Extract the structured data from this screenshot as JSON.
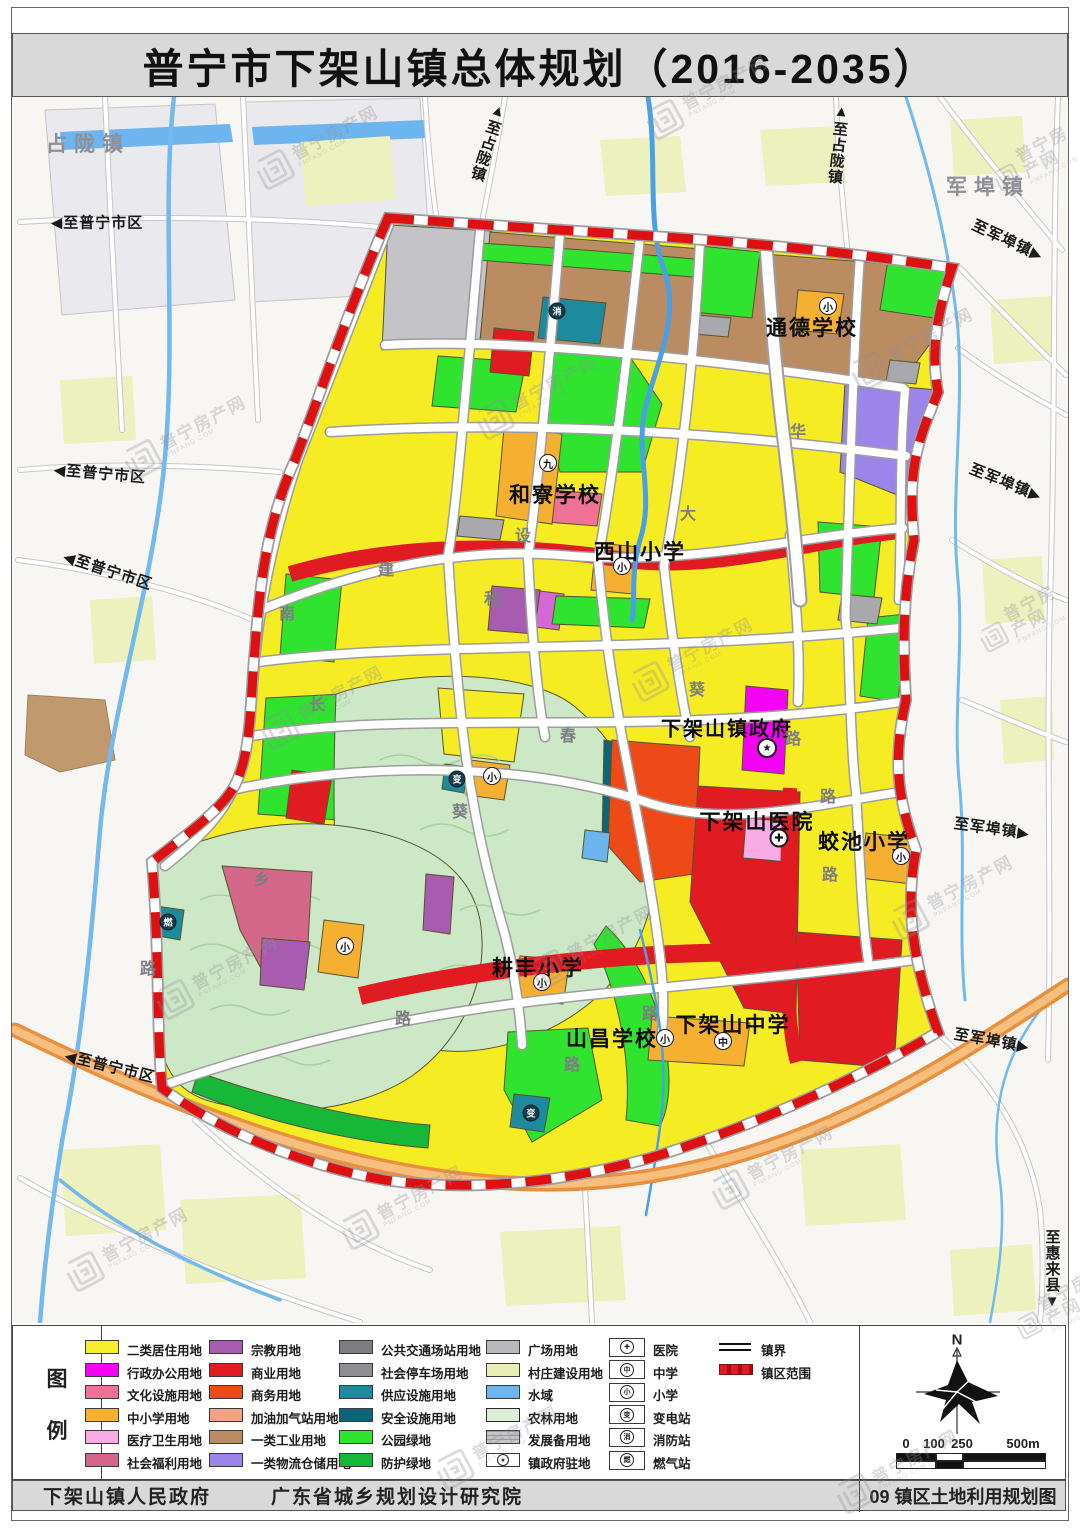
{
  "title": "普宁市下架山镇总体规划（2016-2035）",
  "watermark": {
    "name": "普宁房产网",
    "domain": "PNFANG.COM"
  },
  "compass_label": "N",
  "scalebar": {
    "labels": [
      "0",
      "100",
      "250",
      "500m"
    ]
  },
  "footer": {
    "credit1": "下架山镇人民政府",
    "credit2": "广东省城乡规划设计研究院",
    "sheet_no": "09 镇区土地利用规划图"
  },
  "map": {
    "area_labels": [
      {
        "t": "占陇镇",
        "x": 88,
        "y": 143
      },
      {
        "t": "军埠镇",
        "x": 988,
        "y": 186
      }
    ],
    "edge_labels": [
      {
        "t": "至普宁市区",
        "x": 97,
        "y": 222,
        "a": "l"
      },
      {
        "t": "至普宁市区",
        "x": 100,
        "y": 473,
        "a": "l",
        "r": 5
      },
      {
        "t": "至普宁市区",
        "x": 108,
        "y": 570,
        "a": "l",
        "r": 18
      },
      {
        "t": "至普宁市区",
        "x": 110,
        "y": 1066,
        "a": "l",
        "r": 14
      },
      {
        "t": "至占陇镇",
        "x": 488,
        "y": 142,
        "a": "u",
        "v": 1,
        "r": 18
      },
      {
        "t": "至占陇镇",
        "x": 838,
        "y": 144,
        "a": "u",
        "v": 1,
        "r": 6
      },
      {
        "t": "至军埠镇",
        "x": 1008,
        "y": 240,
        "a": "r",
        "r": 25
      },
      {
        "t": "至军埠镇",
        "x": 1006,
        "y": 482,
        "a": "r",
        "r": 22
      },
      {
        "t": "至军埠镇",
        "x": 992,
        "y": 828,
        "a": "r",
        "r": 8
      },
      {
        "t": "至军埠镇",
        "x": 992,
        "y": 1040,
        "a": "r",
        "r": 10
      },
      {
        "t": "至惠来县",
        "x": 1052,
        "y": 1270,
        "a": "d",
        "v": 1
      }
    ],
    "place_labels": [
      {
        "t": "通德学校",
        "x": 812,
        "y": 327
      },
      {
        "t": "和寮学校",
        "x": 555,
        "y": 494
      },
      {
        "t": "西山小学",
        "x": 640,
        "y": 551
      },
      {
        "t": "下架山镇政府",
        "x": 727,
        "y": 727,
        "s": 20
      },
      {
        "t": "下架山医院",
        "x": 757,
        "y": 821
      },
      {
        "t": "蛟池小学",
        "x": 864,
        "y": 841
      },
      {
        "t": "耕丰小学",
        "x": 538,
        "y": 967
      },
      {
        "t": "山昌学校",
        "x": 612,
        "y": 1038
      },
      {
        "t": "下架山中学",
        "x": 733,
        "y": 1024
      }
    ],
    "road_labels": [
      {
        "t": "建",
        "x": 386,
        "y": 568
      },
      {
        "t": "设",
        "x": 523,
        "y": 534
      },
      {
        "t": "和",
        "x": 492,
        "y": 597
      },
      {
        "t": "大",
        "x": 688,
        "y": 512
      },
      {
        "t": "南",
        "x": 287,
        "y": 612
      },
      {
        "t": "长",
        "x": 317,
        "y": 703
      },
      {
        "t": "春",
        "x": 568,
        "y": 734
      },
      {
        "t": "葵",
        "x": 697,
        "y": 688
      },
      {
        "t": "葵",
        "x": 460,
        "y": 810
      },
      {
        "t": "乡",
        "x": 262,
        "y": 878
      },
      {
        "t": "华",
        "x": 798,
        "y": 430
      },
      {
        "t": "路",
        "x": 793,
        "y": 737
      },
      {
        "t": "路",
        "x": 828,
        "y": 795
      },
      {
        "t": "路",
        "x": 830,
        "y": 873
      },
      {
        "t": "路",
        "x": 650,
        "y": 1012
      },
      {
        "t": "路",
        "x": 572,
        "y": 1063
      },
      {
        "t": "路",
        "x": 148,
        "y": 967
      },
      {
        "t": "路",
        "x": 403,
        "y": 1017
      }
    ],
    "point_icons": [
      {
        "g": "小",
        "x": 828,
        "y": 306,
        "k": "s"
      },
      {
        "g": "小",
        "x": 622,
        "y": 566,
        "k": "s"
      },
      {
        "g": "九",
        "x": 548,
        "y": 463,
        "k": "s"
      },
      {
        "g": "小",
        "x": 492,
        "y": 776,
        "k": "s"
      },
      {
        "g": "小",
        "x": 345,
        "y": 946,
        "k": "s"
      },
      {
        "g": "小",
        "x": 542,
        "y": 982,
        "k": "s"
      },
      {
        "g": "小",
        "x": 665,
        "y": 1038,
        "k": "s"
      },
      {
        "g": "小",
        "x": 901,
        "y": 856,
        "k": "s"
      },
      {
        "g": "中",
        "x": 723,
        "y": 1041,
        "k": "s"
      },
      {
        "g": "★",
        "x": 767,
        "y": 748,
        "k": "g"
      },
      {
        "g": "✚",
        "x": 779,
        "y": 838,
        "k": "h"
      },
      {
        "g": "消",
        "x": 557,
        "y": 311,
        "k": "u"
      },
      {
        "g": "燃",
        "x": 168,
        "y": 922,
        "k": "u"
      },
      {
        "g": "变",
        "x": 531,
        "y": 1113,
        "k": "u"
      },
      {
        "g": "变",
        "x": 457,
        "y": 779,
        "k": "u"
      }
    ]
  },
  "legend": {
    "sidebar_chars": [
      "图",
      "例"
    ],
    "columns": [
      [
        {
          "label": "二类居住用地",
          "color": "#f7ee2e"
        },
        {
          "label": "行政办公用地",
          "color": "#f303f3"
        },
        {
          "label": "文化设施用地",
          "color": "#ef7296"
        },
        {
          "label": "中小学用地",
          "color": "#f5b032"
        },
        {
          "label": "医疗卫生用地",
          "color": "#f8abe4"
        },
        {
          "label": "社会福利用地",
          "color": "#d4688a"
        }
      ],
      [
        {
          "label": "宗教用地",
          "color": "#a85cb0"
        },
        {
          "label": "商业用地",
          "color": "#e01b22"
        },
        {
          "label": "商务用地",
          "color": "#ee4a17"
        },
        {
          "label": "加油加气站用地",
          "color": "#f2a285"
        },
        {
          "label": "一类工业用地",
          "color": "#bb8c62"
        },
        {
          "label": "一类物流仓储用地",
          "color": "#9c85ea"
        }
      ],
      [
        {
          "label": "公共交通场站用地",
          "color": "#7e7e82"
        },
        {
          "label": "社会停车场用地",
          "color": "#8f8f93"
        },
        {
          "label": "供应设施用地",
          "color": "#1d8a9e"
        },
        {
          "label": "安全设施用地",
          "color": "#0f6578"
        },
        {
          "label": "公园绿地",
          "color": "#2fe32f"
        },
        {
          "label": "防护绿地",
          "color": "#17b837"
        }
      ],
      [
        {
          "label": "广场用地",
          "color": "#b9b9bd"
        },
        {
          "label": "村庄建设用地",
          "color": "#e9efb4"
        },
        {
          "label": "水域",
          "color": "#6db5ef"
        },
        {
          "label": "农林用地",
          "color": "#dcedd8",
          "v": "bordered"
        },
        {
          "label": "发展备用地",
          "color": "#c6c6ca",
          "v": "striped"
        },
        {
          "label": "镇政府驻地",
          "color": "#ffffff",
          "v": "iconbox",
          "glyph": "★"
        }
      ]
    ],
    "symbols": [
      {
        "label": "医院",
        "g": "✚"
      },
      {
        "label": "中学",
        "g": "中"
      },
      {
        "label": "小学",
        "g": "小"
      },
      {
        "label": "变电站",
        "g": "变"
      },
      {
        "label": "消防站",
        "g": "消"
      },
      {
        "label": "燃气站",
        "g": "燃"
      }
    ],
    "lines": [
      {
        "label": "镇界",
        "style": "double"
      },
      {
        "label": "镇区范围",
        "style": "reddash"
      }
    ]
  }
}
